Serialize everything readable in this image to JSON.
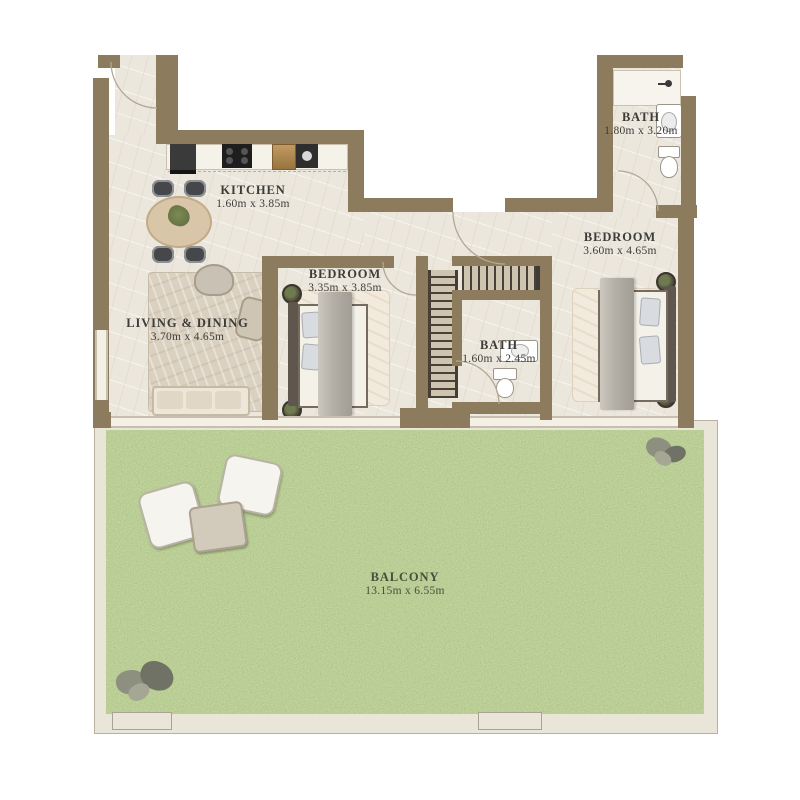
{
  "plan": {
    "rooms": [
      {
        "id": "kitchen",
        "name": "KITCHEN",
        "dims": "1.60m x 3.85m"
      },
      {
        "id": "living",
        "name": "LIVING & DINING",
        "dims": "3.70m x 4.65m"
      },
      {
        "id": "bedroom1",
        "name": "BEDROOM",
        "dims": "3.35m x 3.85m"
      },
      {
        "id": "bedroom2",
        "name": "BEDROOM",
        "dims": "3.60m x 4.65m"
      },
      {
        "id": "bath1",
        "name": "BATH",
        "dims": "1.80m x 3.20m"
      },
      {
        "id": "bath2",
        "name": "BATH",
        "dims": "1.60m x 2.45m"
      },
      {
        "id": "balcony",
        "name": "BALCONY",
        "dims": "13.15m x 6.55m"
      }
    ],
    "colors": {
      "wall": "#8d7b5e",
      "floor": "#ece7dd",
      "glazing": "#f4f0e6",
      "frame": "#e9e5d8",
      "grass": "#7d914e",
      "label": "#3c3c38",
      "balcony_label": "#47503a"
    }
  }
}
